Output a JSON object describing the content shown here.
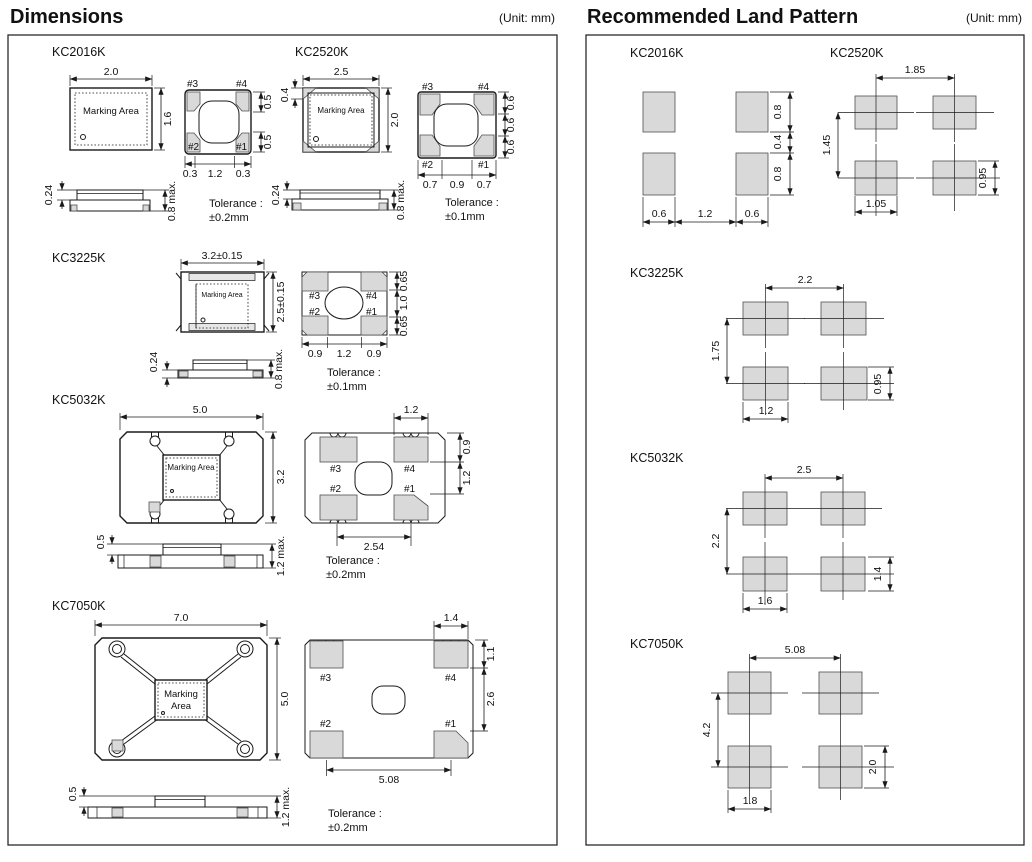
{
  "header": {
    "dimensions_title": "Dimensions",
    "land_title": "Recommended Land Pattern",
    "unit": "(Unit: mm)"
  },
  "labels": {
    "marking_area": "Marking Area",
    "marking_line1": "Marking",
    "marking_line2": "Area",
    "tolerance": "Tolerance :",
    "pad1": "#1",
    "pad2": "#2",
    "pad3": "#3",
    "pad4": "#4"
  },
  "dimensions": {
    "kc2016k": {
      "name": "KC2016K",
      "top_w": "2.0",
      "top_h": "1.6",
      "pad_r1": "0.5",
      "pad_r2": "0.5",
      "pad_b1": "0.3",
      "pad_b2": "1.2",
      "pad_b3": "0.3",
      "side_a": "0.24",
      "side_b": "0.8 max.",
      "tol": "±0.2mm"
    },
    "kc2520k": {
      "name": "KC2520K",
      "top_w": "2.5",
      "top_h": "2.0",
      "top_l": "0.4",
      "pad_r1": "0.6",
      "pad_r2": "0.6",
      "pad_r3": "0.6",
      "pad_b1": "0.7",
      "pad_b2": "0.9",
      "pad_b3": "0.7",
      "side_a": "0.24",
      "side_b": "0.8 max.",
      "tol": "±0.1mm"
    },
    "kc3225k": {
      "name": "KC3225K",
      "top_w": "3.2±0.15",
      "top_h": "2.5±0.15",
      "pad_r1": "0.65",
      "pad_r2": "1.0",
      "pad_r3": "0.65",
      "pad_b1": "0.9",
      "pad_b2": "1.2",
      "pad_b3": "0.9",
      "side_a": "0.24",
      "side_b": "0.8 max.",
      "tol": "±0.1mm"
    },
    "kc5032k": {
      "name": "KC5032K",
      "top_w": "5.0",
      "top_h": "3.2",
      "pad_t": "1.2",
      "pad_r1": "0.9",
      "pad_r2": "1.2",
      "pad_b": "2.54",
      "side_a": "0.5",
      "side_b": "1.2 max.",
      "tol": "±0.2mm"
    },
    "kc7050k": {
      "name": "KC7050K",
      "top_w": "7.0",
      "top_h": "5.0",
      "pad_t": "1.4",
      "pad_r1": "1.1",
      "pad_r2": "2.6",
      "pad_b": "5.08",
      "side_a": "0.5",
      "side_b": "1.2 max.",
      "tol": "±0.2mm"
    }
  },
  "land_pattern": {
    "kc2016k": {
      "name": "KC2016K",
      "right_top": "0.8",
      "right_mid": "0.4",
      "right_bottom": "0.8",
      "bottom_left": "0.6",
      "bottom_mid": "1.2",
      "bottom_right": "0.6"
    },
    "kc2520k": {
      "name": "KC2520K",
      "pitch_x": "1.85",
      "pitch_y": "1.45",
      "pad_w": "1.05",
      "pad_h": "0.95"
    },
    "kc3225k": {
      "name": "KC3225K",
      "pitch_x": "2.2",
      "pitch_y": "1.75",
      "pad_w": "1.2",
      "pad_h": "0.95"
    },
    "kc5032k": {
      "name": "KC5032K",
      "pitch_x": "2.5",
      "pitch_y": "2.2",
      "pad_w": "1.6",
      "pad_h": "1.4"
    },
    "kc7050k": {
      "name": "KC7050K",
      "pitch_x": "5.08",
      "pitch_y": "4.2",
      "pad_w": "1.8",
      "pad_h": "2.0"
    }
  },
  "colors": {
    "pad_fill": "#d9d9d9",
    "line": "#1a1a1a",
    "background": "#ffffff"
  }
}
